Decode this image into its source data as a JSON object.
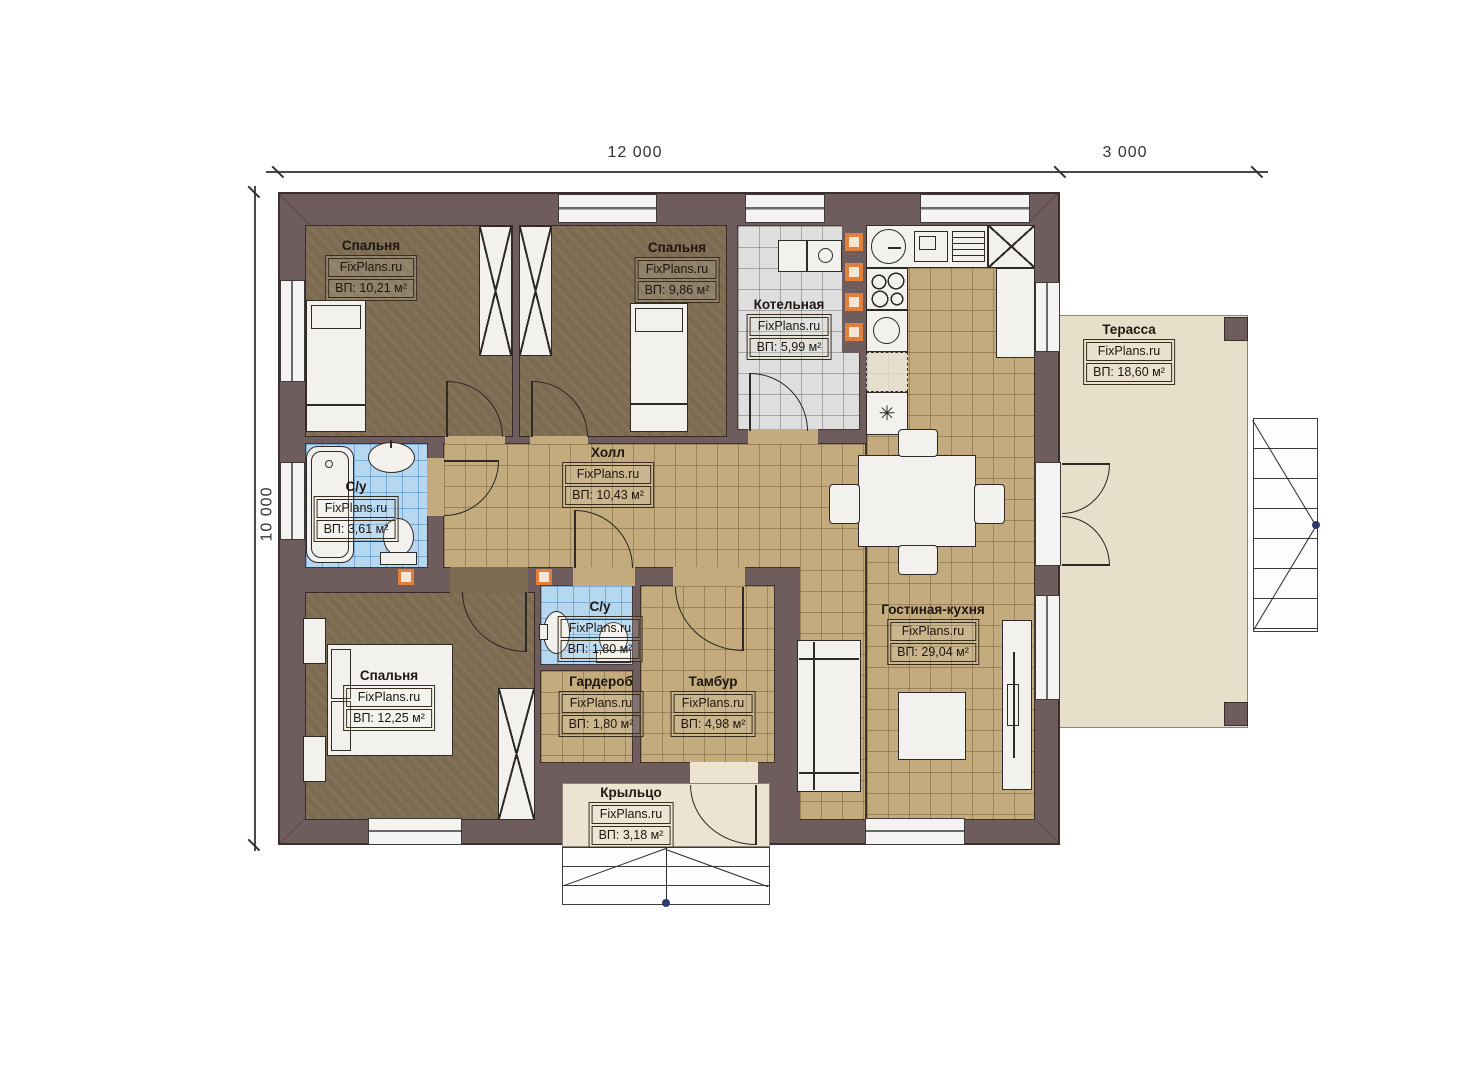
{
  "dims": {
    "top": "12 000",
    "right": "3 000",
    "left": "10 000"
  },
  "brand": "FixPlans.ru",
  "rooms": {
    "bedroom1": {
      "name": "Спальня",
      "area": "ВП: 10,21 м²"
    },
    "bedroom2": {
      "name": "Спальня",
      "area": "ВП: 9,86 м²"
    },
    "boiler": {
      "name": "Котельная",
      "area": "ВП: 5,99 м²"
    },
    "terrace": {
      "name": "Терасса",
      "area": "ВП: 18,60 м²"
    },
    "hall": {
      "name": "Холл",
      "area": "ВП: 10,43 м²"
    },
    "bath1": {
      "name": "С/у",
      "area": "ВП: 3,61 м²"
    },
    "bedroom3": {
      "name": "Спальня",
      "area": "ВП: 12,25 м²"
    },
    "bath2": {
      "name": "С/у",
      "area": "ВП: 1,80 м²"
    },
    "wardrobe": {
      "name": "Гардероб",
      "area": "ВП: 1,80 м²"
    },
    "vestibule": {
      "name": "Тамбур",
      "area": "ВП: 4,98 м²"
    },
    "living": {
      "name": "Гостиная-кухня",
      "area": "ВП: 29,04 м²"
    },
    "porch": {
      "name": "Крыльцо",
      "area": "ВП: 3,18 м²"
    }
  },
  "symbols": {
    "freezer": "✳"
  },
  "colors": {
    "wall": "#6f5d5d",
    "floor_wood": "#7c6b50",
    "tile_tan": "#c4ab7e",
    "tile_gray": "#dedede",
    "tile_blue": "#b5d7f0",
    "terrace_beige": "#e8dfca",
    "accent_orange": "#e0803a"
  }
}
